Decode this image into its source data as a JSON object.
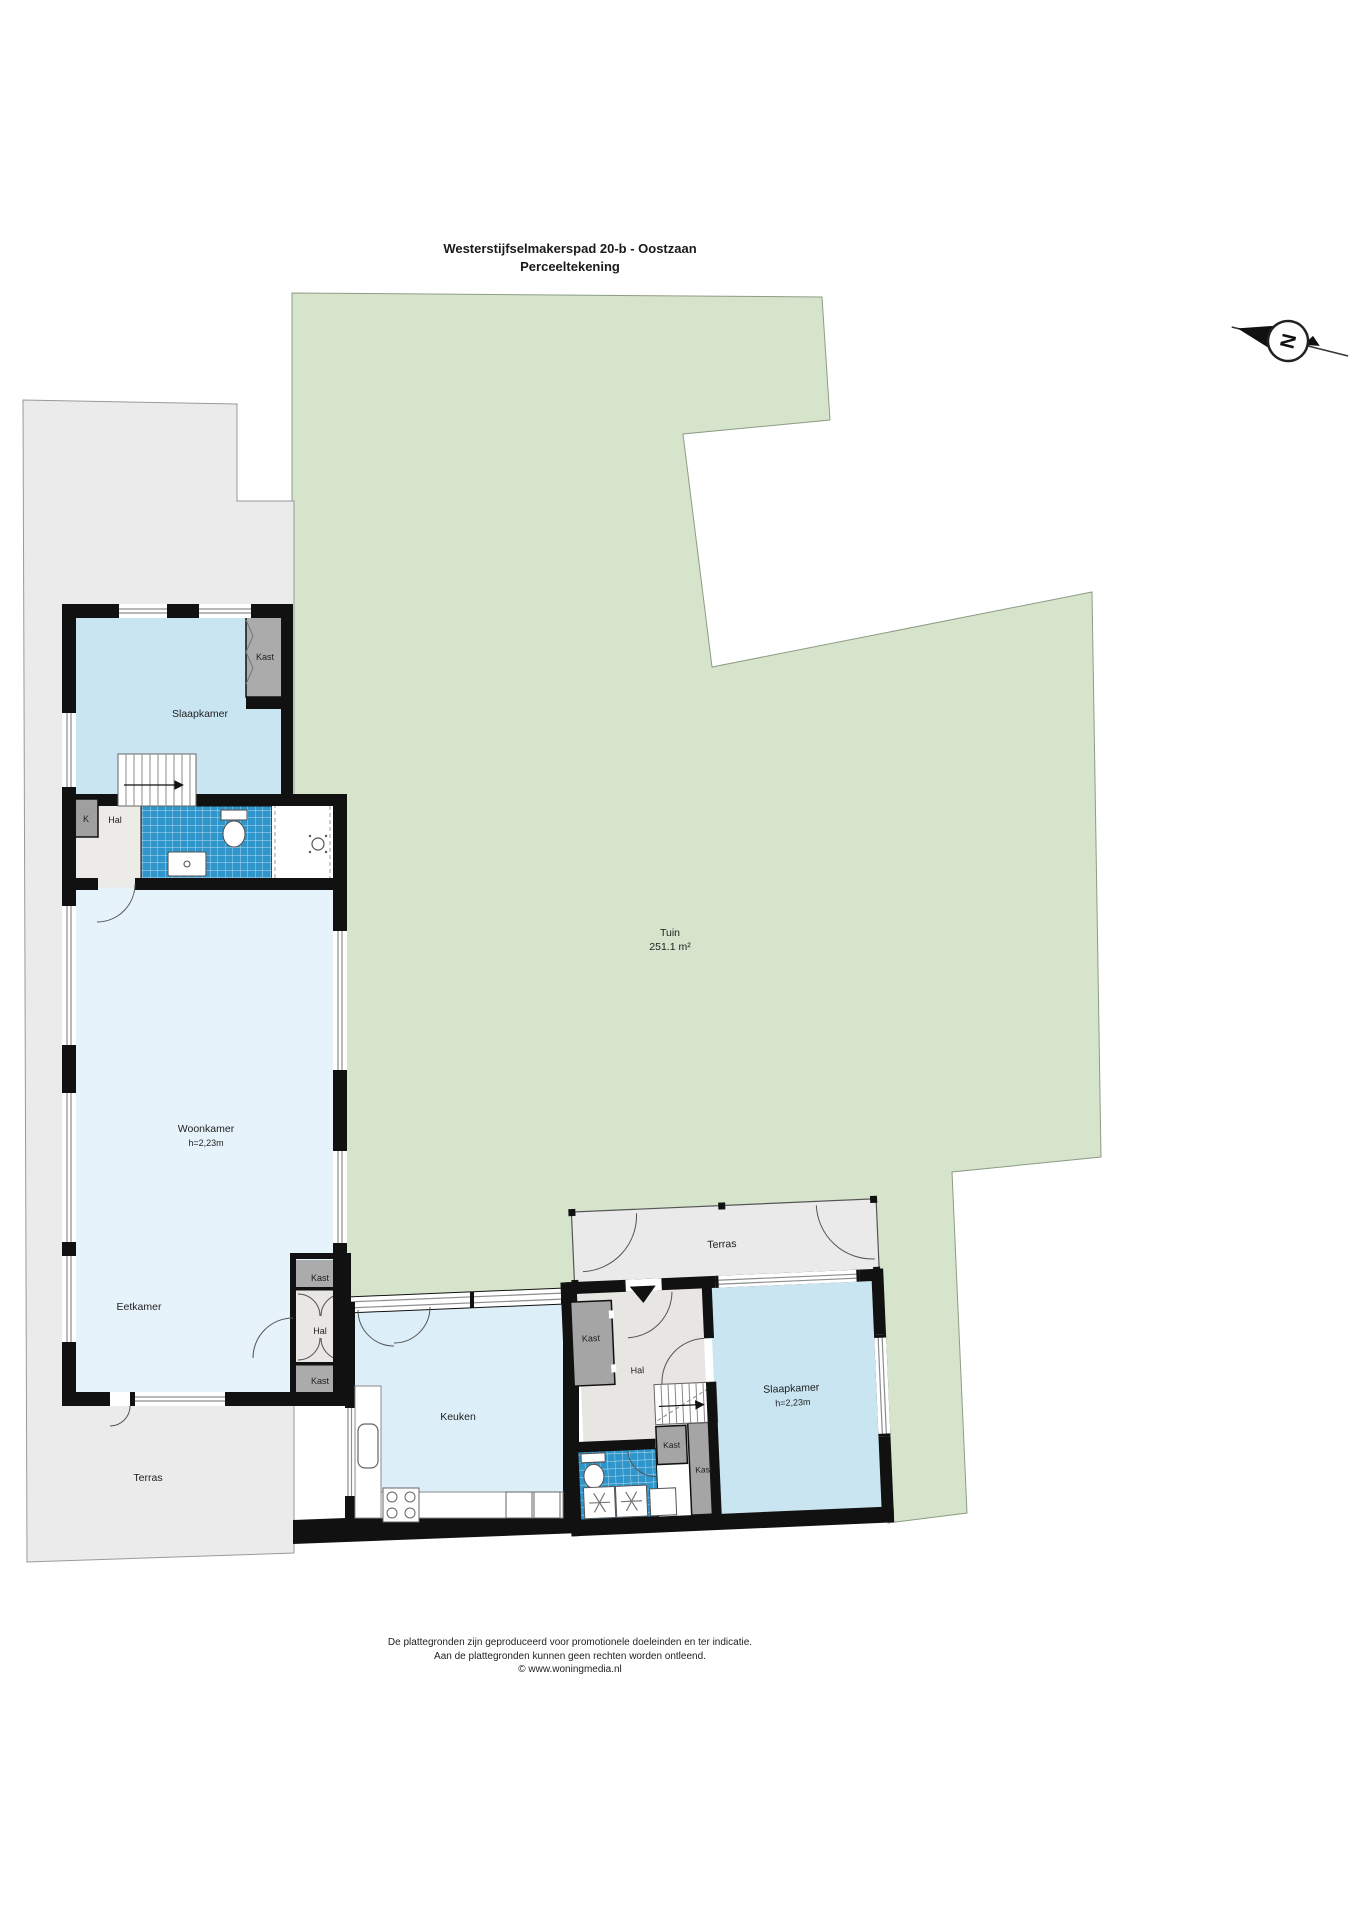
{
  "header": {
    "title": "Westerstijfselmakerspad 20-b - Oostzaan",
    "subtitle": "Perceeltekening"
  },
  "compass": {
    "north": "N"
  },
  "garden": {
    "label": "Tuin",
    "area": "251.1 m²"
  },
  "terrace_left": {
    "label": "Terras"
  },
  "building_left": {
    "slaapkamer": {
      "label": "Slaapkamer"
    },
    "kast_slaapkamer": {
      "label": "Kast"
    },
    "k_closet": {
      "label": "K"
    },
    "hal_boven": {
      "label": "Hal"
    },
    "woonkamer": {
      "label": "Woonkamer",
      "ceiling_height": "h=2,23m"
    },
    "eetkamer": {
      "label": "Eetkamer"
    },
    "hal_eetkamer": {
      "label": "Hal"
    },
    "kast_hal_boven": {
      "label": "Kast"
    },
    "kast_hal_onder": {
      "label": "Kast"
    }
  },
  "building_middle": {
    "keuken": {
      "label": "Keuken"
    }
  },
  "building_right": {
    "terras": {
      "label": "Terras"
    },
    "hal": {
      "label": "Hal"
    },
    "kast_entree": {
      "label": "Kast"
    },
    "kast_klein": {
      "label": "Kast"
    },
    "kast_groot": {
      "label": "Kast"
    },
    "slaapkamer": {
      "label": "Slaapkamer",
      "ceiling_height": "h=2,23m"
    }
  },
  "footer": {
    "line1": "De plattegronden zijn geproduceerd voor promotionele doeleinden en ter indicatie.",
    "line2": "Aan de plattegronden kunnen geen rechten worden ontleend.",
    "line3": "© www.woningmedia.nl"
  },
  "colors": {
    "garden_green": "#d5e4cb",
    "terrace_gray": "#ebebeb",
    "room_blue": "#c9e5f2",
    "room_blue_light": "#e7f3fa",
    "keuken_blue": "#dceef8",
    "tile_blue": "#2e96cb",
    "closet_gray": "#ababab",
    "hall_gray": "#e9e7e3",
    "wall_black": "#111111"
  }
}
